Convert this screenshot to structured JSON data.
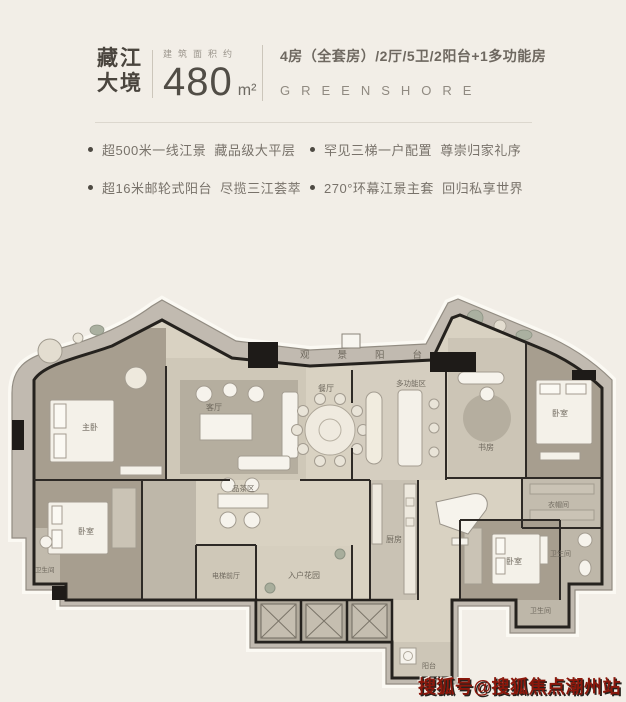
{
  "header": {
    "project_name": [
      "藏江",
      "大境"
    ],
    "area_label": "建筑面积约",
    "area_value": "480",
    "area_unit": "m²",
    "layout_spec": "4房（全套房）/2厅/5卫/2阳台+1多功能房",
    "brand_en": "GREENSHORE"
  },
  "selling_points": [
    "超500米一线江景  藏品级大平层",
    "罕见三梯一户配置  尊崇归家礼序",
    "超16米邮轮式阳台  尽揽三江荟萃",
    "270°环幕江景主套  回归私享世界"
  ],
  "floorplan": {
    "labels": {
      "top_balcony": "观景阳台",
      "master_bedroom": "主卧",
      "bedroom_2": "卧室",
      "bedroom_3": "卧室",
      "bedroom_4": "卧室",
      "living_room": "客厅",
      "dining_room": "餐厅",
      "multi_function": "多功能区",
      "study": "书房",
      "tea_area": "品茶区",
      "kitchen": "厨房",
      "entry_garden": "入户花园",
      "elevator_hall": "电梯前厅",
      "cloakroom": "衣帽间",
      "bathroom_a": "卫生间",
      "bathroom_b": "卫生间",
      "bathroom_c": "卫生间",
      "service_balcony": "阳台"
    }
  },
  "watermark": "搜狐号@搜狐焦点潮州站",
  "colors": {
    "accent_red": "#8b170b",
    "wall": "#25221e",
    "floor_beige": "#d9d2c2",
    "balcony_gray": "#c1bab0"
  }
}
